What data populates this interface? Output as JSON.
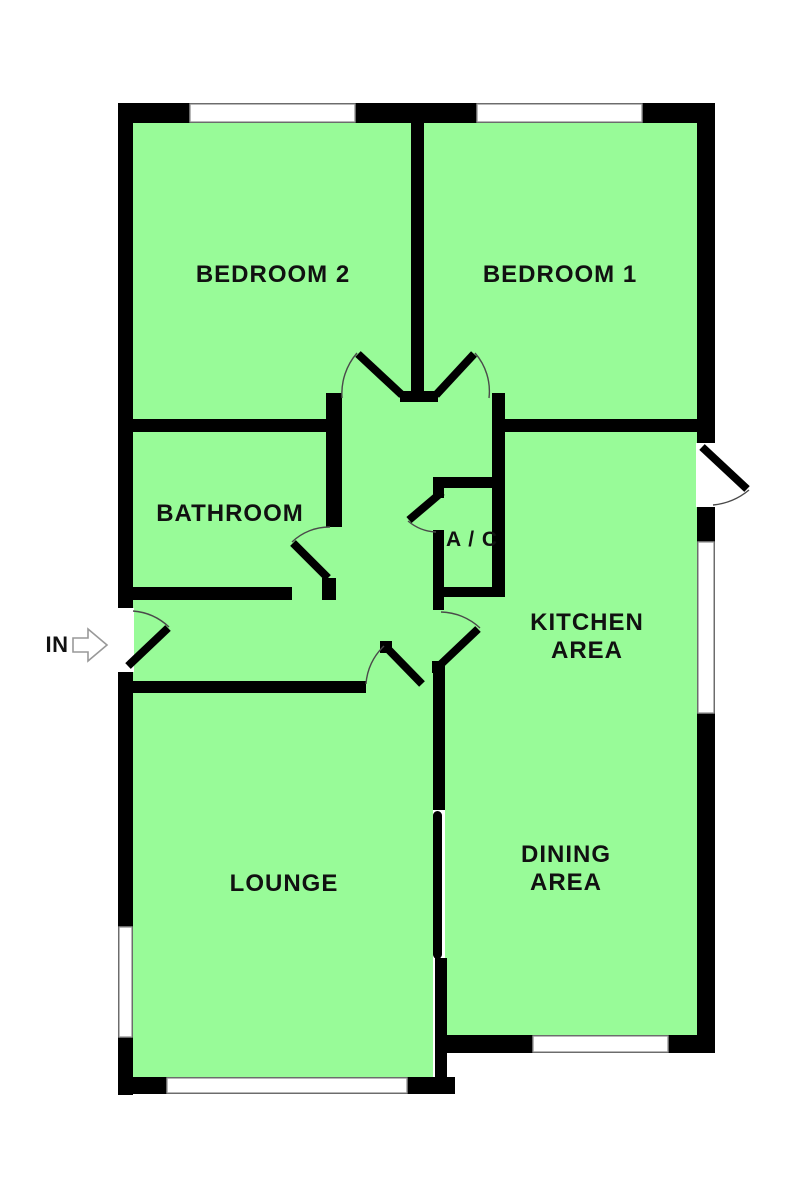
{
  "title": "Bungalow floor plan",
  "colors": {
    "floor": "#98FB98",
    "wall": "#000000",
    "window_frame": "#9A9A9A",
    "door_arc": "#4A4A4A",
    "door_leaf": "#000000",
    "label": "#111111",
    "arrow_outline": "#999999",
    "background": "#FFFFFF"
  },
  "rooms": {
    "bedroom2": "BEDROOM 2",
    "bedroom1": "BEDROOM 1",
    "bathroom": "BATHROOM",
    "ac": "A / C",
    "kitchen_line1": "KITCHEN",
    "kitchen_line2": "AREA",
    "dining_line1": "DINING",
    "dining_line2": "AREA",
    "lounge": "LOUNGE"
  },
  "entrance": {
    "label": "IN"
  }
}
